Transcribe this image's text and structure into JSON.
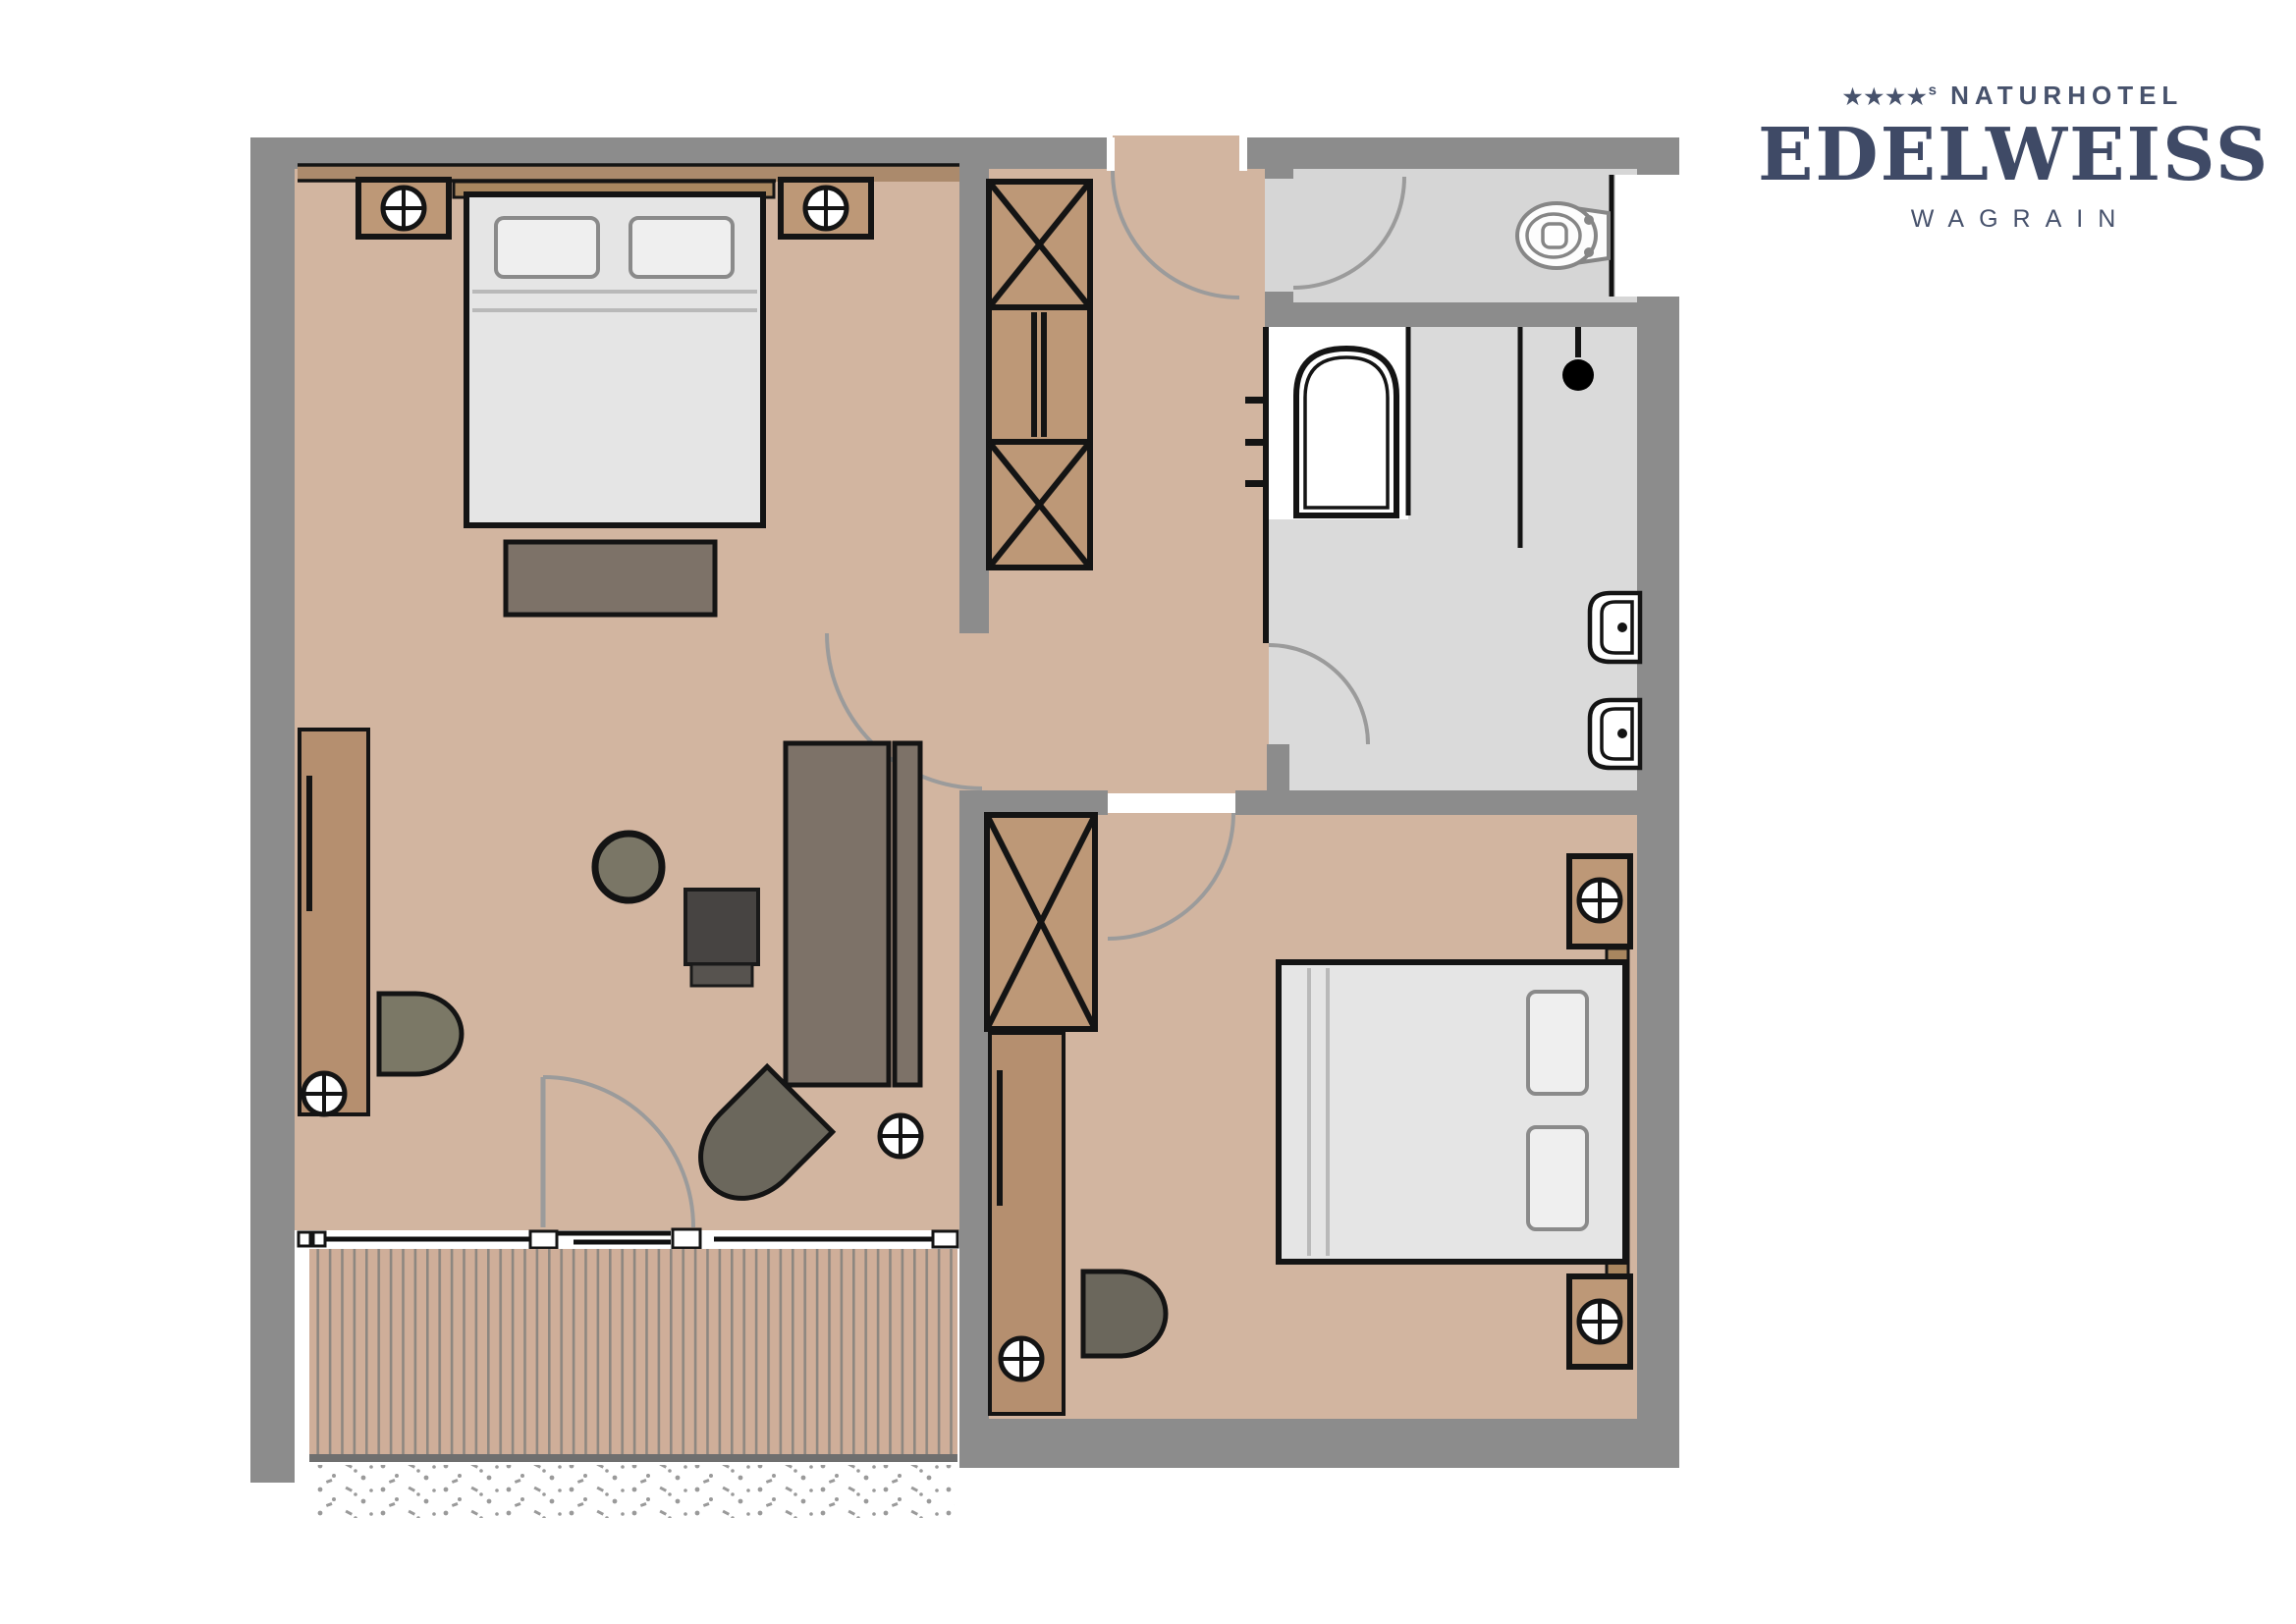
{
  "brand": {
    "stars": "★★★★",
    "stars_superscript": "s",
    "prefix": "NATURHOTEL",
    "name": "EDELWEISS",
    "location": "WAGRAIN"
  },
  "colors": {
    "wall": "#8c8c8c",
    "floor": "#d2b5a0",
    "bath-floor": "#dadada",
    "toilet-floor": "#d6d6d6",
    "wood": "#bd9877",
    "wood-dark": "#b58f6f",
    "headboard": "#a8865f",
    "taupe": "#7d7268",
    "olive": "#7b7866",
    "olive-dark": "#6b675c",
    "charcoal": "#474442",
    "bed": "#e5e5e5",
    "pillow": "#efefef",
    "line": "#141414",
    "door-arc": "#9b9b9b",
    "brand": "#3f4a66",
    "brand-light": "#47526c",
    "deck": "#cfae99",
    "deck-line": "#8d8780",
    "white": "#ffffff",
    "fixture": "#868686"
  },
  "floor_plan": {
    "type": "hotel-suite-floor-plan",
    "rooms": [
      {
        "id": "bedroom-1",
        "elements": [
          "double-bed",
          "two-pillows",
          "headboard",
          "nightstand-with-lamp-left",
          "nightstand-with-lamp-right",
          "bench-at-bed-foot",
          "wall-sideboard",
          "sideboard-lamp",
          "armchair",
          "round-side-table",
          "desk-chair-dark",
          "long-desk",
          "lounge-chair",
          "floor-lamp",
          "balcony-door-swing"
        ]
      },
      {
        "id": "balcony",
        "elements": [
          "wood-deck-planks",
          "sliding-window-front",
          "gravel-strip"
        ]
      },
      {
        "id": "hallway",
        "elements": [
          "entry-door-swing",
          "wardrobe-crossed-top",
          "wardrobe-shelves",
          "wardrobe-crossed-bottom",
          "coat-hooks",
          "door-to-bedroom-1",
          "door-to-bedroom-2"
        ]
      },
      {
        "id": "wc",
        "elements": [
          "toilet",
          "door-swing",
          "window"
        ]
      },
      {
        "id": "bathroom",
        "elements": [
          "bathtub",
          "glass-partition",
          "shower-head",
          "washbasin-upper",
          "washbasin-lower",
          "door-swing"
        ]
      },
      {
        "id": "bedroom-2",
        "elements": [
          "double-bed",
          "two-pillows",
          "headboard",
          "nightstand-with-lamp-top",
          "nightstand-with-lamp-bottom",
          "wardrobe-crossed",
          "tall-cabinet",
          "cabinet-lamp",
          "armchair",
          "door-swing"
        ]
      }
    ]
  }
}
